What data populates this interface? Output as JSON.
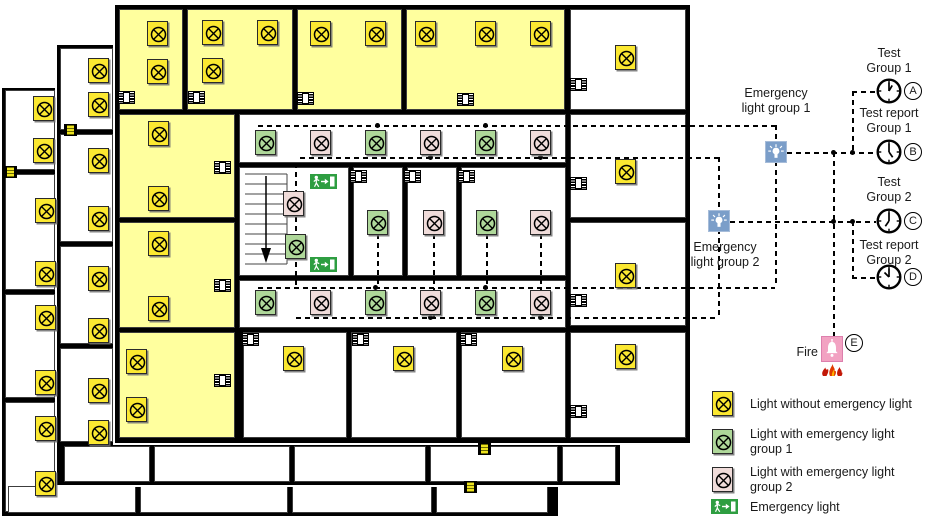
{
  "canvas": {
    "width": 927,
    "height": 519
  },
  "colors": {
    "room_yellow": "#FFFF9E",
    "light_yellow": "#FBE831",
    "light_green": "#AFD89A",
    "light_pink": "#F0DCDA",
    "group_icon_blue": "#7B9EC9",
    "fire_pink": "#F2A2C2",
    "exit_green": "#2E9E41",
    "wall_black": "#000000"
  },
  "right_panel": {
    "group1_label": "Emergency\nlight group 1",
    "group2_label": "Emergency\nlight group 2",
    "fire_label": "Fire",
    "fire_badge": "E",
    "clocks": [
      {
        "label": "Test\nGroup 1",
        "badge": "A",
        "x": 889,
        "y": 91,
        "label_y": 46,
        "hour_angle": 30
      },
      {
        "label": "Test report\nGroup 1",
        "badge": "B",
        "x": 889,
        "y": 152,
        "label_y": 106,
        "hour_angle": 145
      },
      {
        "label": "Test\nGroup 2",
        "badge": "C",
        "x": 889,
        "y": 221,
        "label_y": 175,
        "hour_angle": 215
      },
      {
        "label": "Test report\nGroup 2",
        "badge": "D",
        "x": 889,
        "y": 277,
        "label_y": 238,
        "hour_angle": 315
      }
    ]
  },
  "legend": {
    "items": [
      {
        "icon": "light-without-emergency",
        "type": "n",
        "label": "Light without emergency light",
        "icon_y": 391,
        "text_y": 397
      },
      {
        "icon": "light-emergency-group1",
        "type": "g1",
        "label": "Light with emergency light\ngroup 1",
        "icon_y": 429,
        "text_y": 427
      },
      {
        "icon": "light-emergency-group2",
        "type": "g2",
        "label": "Light with emergency light\ngroup 2",
        "icon_y": 467,
        "text_y": 465
      },
      {
        "icon": "emergency-exit-sign",
        "type": "exit",
        "label": "Emergency light",
        "icon_y": 499,
        "text_y": 500
      }
    ]
  },
  "floorplan": {
    "layers": [
      {
        "name": "floor-back",
        "rect": [
          2,
          88,
          556,
          428
        ],
        "rooms": [
          [
            5,
            90,
            50,
            80
          ],
          [
            5,
            174,
            50,
            116
          ],
          [
            5,
            294,
            50,
            104
          ],
          [
            5,
            402,
            50,
            110
          ],
          [
            8,
            486,
            128,
            27
          ],
          [
            140,
            486,
            148,
            27
          ],
          [
            292,
            486,
            140,
            27
          ],
          [
            436,
            486,
            112,
            27
          ]
        ],
        "lights_n": [
          [
            43,
            108
          ],
          [
            43,
            150
          ],
          [
            45,
            210
          ],
          [
            45,
            273
          ],
          [
            45,
            317
          ],
          [
            45,
            382
          ],
          [
            45,
            428
          ],
          [
            45,
            483
          ]
        ],
        "ydoors": [
          [
            10,
            172
          ],
          [
            470,
            487
          ]
        ]
      },
      {
        "name": "floor-middle",
        "rect": [
          57,
          45,
          563,
          440
        ],
        "rooms": [
          [
            60,
            48,
            53,
            82
          ],
          [
            60,
            134,
            53,
            108
          ],
          [
            60,
            246,
            53,
            98
          ],
          [
            60,
            348,
            53,
            94
          ],
          [
            64,
            446,
            86,
            36
          ],
          [
            154,
            446,
            136,
            36
          ],
          [
            294,
            446,
            132,
            36
          ],
          [
            430,
            446,
            128,
            36
          ],
          [
            562,
            446,
            54,
            36
          ]
        ],
        "lights_n": [
          [
            98,
            70
          ],
          [
            98,
            104
          ],
          [
            98,
            160
          ],
          [
            98,
            218
          ],
          [
            98,
            278
          ],
          [
            98,
            330
          ],
          [
            98,
            390
          ],
          [
            98,
            432
          ]
        ],
        "ydoors": [
          [
            70,
            130
          ],
          [
            484,
            449
          ]
        ]
      },
      {
        "name": "floor-main",
        "rect": [
          115,
          5,
          575,
          438
        ],
        "rooms": [
          [
            119,
            9,
            64,
            101,
            "y"
          ],
          [
            187,
            9,
            106,
            101,
            "y"
          ],
          [
            297,
            9,
            105,
            101,
            "y"
          ],
          [
            406,
            9,
            159,
            101,
            "y"
          ],
          [
            570,
            9,
            116,
            101
          ],
          [
            119,
            114,
            116,
            104,
            "y"
          ],
          [
            119,
            222,
            116,
            106,
            "y"
          ],
          [
            119,
            332,
            116,
            106,
            "y"
          ],
          [
            239,
            114,
            327,
            49
          ],
          [
            239,
            280,
            327,
            48
          ],
          [
            239,
            167,
            110,
            109,
            "stairs"
          ],
          [
            353,
            167,
            50,
            109
          ],
          [
            407,
            167,
            50,
            109
          ],
          [
            461,
            167,
            105,
            109
          ],
          [
            243,
            332,
            104,
            106
          ],
          [
            351,
            332,
            106,
            106
          ],
          [
            461,
            332,
            105,
            106
          ],
          [
            570,
            114,
            116,
            104
          ],
          [
            570,
            222,
            116,
            104
          ],
          [
            570,
            332,
            116,
            106
          ]
        ],
        "lights_n": [
          [
            157,
            33
          ],
          [
            157,
            71
          ],
          [
            212,
            32
          ],
          [
            267,
            32
          ],
          [
            212,
            70
          ],
          [
            320,
            33
          ],
          [
            375,
            33
          ],
          [
            425,
            33
          ],
          [
            485,
            33
          ],
          [
            540,
            33
          ],
          [
            625,
            57
          ],
          [
            158,
            133
          ],
          [
            158,
            198
          ],
          [
            158,
            243
          ],
          [
            158,
            308
          ],
          [
            136,
            361
          ],
          [
            136,
            409
          ],
          [
            293,
            358
          ],
          [
            403,
            358
          ],
          [
            512,
            358
          ],
          [
            625,
            171
          ],
          [
            625,
            275
          ],
          [
            625,
            356
          ]
        ],
        "lights_g1": [
          [
            265,
            142
          ],
          [
            375,
            142
          ],
          [
            485,
            142
          ],
          [
            295,
            246
          ],
          [
            377,
            222
          ],
          [
            486,
            222
          ],
          [
            265,
            302
          ],
          [
            375,
            302
          ],
          [
            485,
            302
          ]
        ],
        "lights_g2": [
          [
            320,
            142
          ],
          [
            430,
            142
          ],
          [
            540,
            142
          ],
          [
            293,
            203
          ],
          [
            433,
            222
          ],
          [
            540,
            222
          ],
          [
            320,
            302
          ],
          [
            430,
            302
          ],
          [
            540,
            302
          ]
        ],
        "doors": [
          [
            126,
            97
          ],
          [
            196,
            97
          ],
          [
            305,
            98
          ],
          [
            465,
            99
          ],
          [
            578,
            84
          ],
          [
            578,
            183
          ],
          [
            578,
            300
          ],
          [
            578,
            411
          ],
          [
            222,
            167
          ],
          [
            222,
            285
          ],
          [
            222,
            380
          ],
          [
            358,
            176
          ],
          [
            412,
            176
          ],
          [
            466,
            176
          ],
          [
            250,
            339
          ],
          [
            360,
            339
          ],
          [
            468,
            339
          ]
        ],
        "ydoors": [],
        "exits": [
          [
            323,
            181
          ],
          [
            323,
            264
          ]
        ]
      }
    ],
    "wiring": {
      "hlines": [
        [
          258,
          125,
          517
        ],
        [
          300,
          157,
          418
        ],
        [
          258,
          287,
          517
        ],
        [
          296,
          317,
          422
        ],
        [
          787,
          152,
          89
        ],
        [
          730,
          221,
          146
        ],
        [
          852,
          91,
          24
        ],
        [
          852,
          277,
          24
        ]
      ],
      "vlines": [
        [
          775,
          125,
          162
        ],
        [
          718,
          157,
          160
        ],
        [
          852,
          91,
          61
        ],
        [
          852,
          221,
          56
        ],
        [
          833,
          152,
          186
        ],
        [
          295,
          163,
          122
        ],
        [
          377,
          234,
          53
        ],
        [
          433,
          234,
          83
        ],
        [
          486,
          234,
          53
        ],
        [
          540,
          234,
          83
        ]
      ],
      "dots": [
        [
          377,
          125
        ],
        [
          485,
          125
        ],
        [
          430,
          157
        ],
        [
          540,
          157
        ],
        [
          375,
          287
        ],
        [
          485,
          287
        ],
        [
          430,
          317
        ],
        [
          540,
          317
        ],
        [
          833,
          152
        ],
        [
          852,
          152
        ],
        [
          833,
          221
        ],
        [
          852,
          221
        ]
      ],
      "group1_icon": {
        "x": 765,
        "y": 141
      },
      "group2_icon": {
        "x": 708,
        "y": 210
      },
      "fire_icon": {
        "x": 821,
        "y": 336
      }
    }
  }
}
